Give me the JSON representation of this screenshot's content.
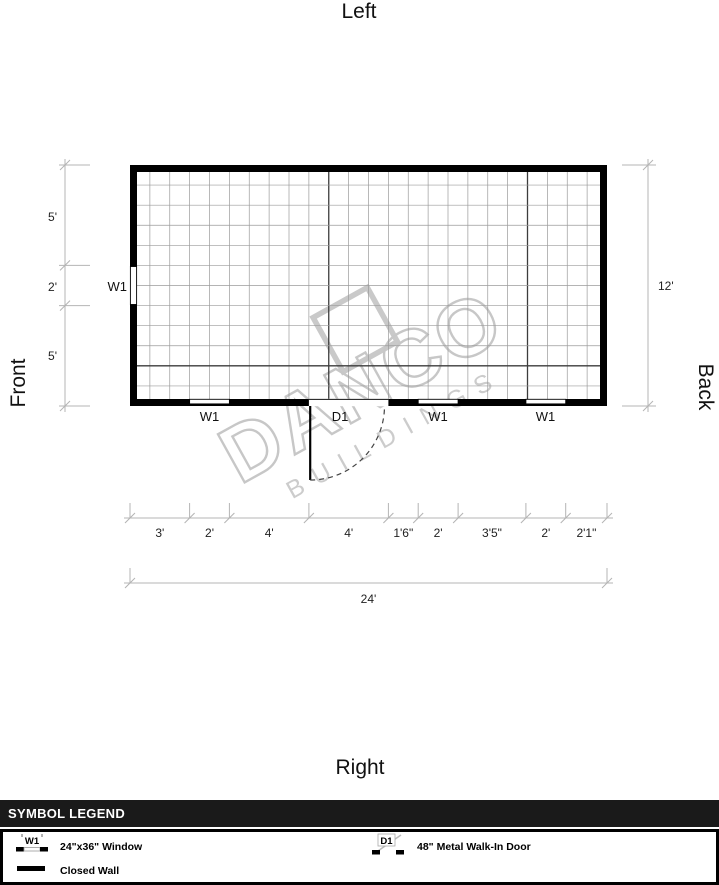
{
  "sides": {
    "top": "Left",
    "bottom": "Right",
    "left": "Front",
    "right": "Back"
  },
  "dimensions": {
    "left": [
      "5'",
      "2'",
      "5'"
    ],
    "right": "12'",
    "bottom_segments": [
      "3'",
      "2'",
      "4'",
      "4'",
      "1'6\"",
      "2'",
      "3'5\"",
      "2'",
      "2'1\""
    ],
    "bottom_total": "24'"
  },
  "plan_labels": {
    "left_window": "W1",
    "bottom": [
      "W1",
      "D1",
      "W1",
      "W1"
    ]
  },
  "watermark": {
    "line1": "DANCO",
    "line2": "BUILDINGS"
  },
  "legend": {
    "header": "SYMBOL LEGEND",
    "items": [
      {
        "symbol": "W1",
        "label": "24\"x36\" Window"
      },
      {
        "symbol": "D1",
        "label": "48\" Metal Walk-In Door"
      },
      {
        "symbol": "",
        "label": "Closed Wall"
      }
    ]
  },
  "colors": {
    "wall": "#000000",
    "dimension_lines": "#b4b4b4",
    "grid_minor": "#9b9b9b",
    "watermark": "#c9c9c9",
    "legend_header_bg": "#1a1a1a"
  }
}
